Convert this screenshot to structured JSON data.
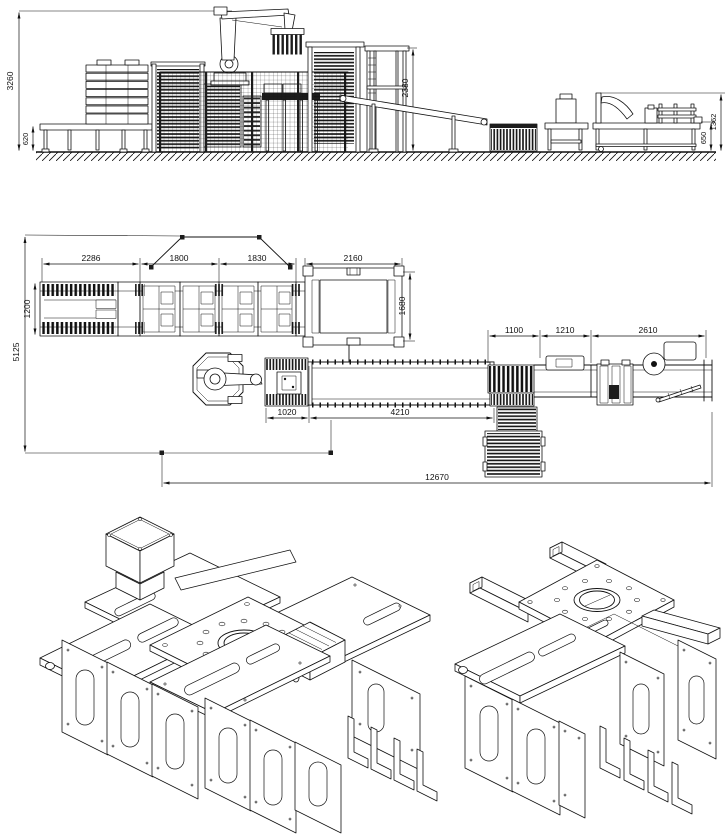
{
  "elevation_view": {
    "dimensions": {
      "overall_height": "3260",
      "infeed_conveyor_height": "620",
      "hoist_frame_height": "2380",
      "outfeed_station_height": "1362",
      "outfeed_conveyor_height": "650"
    }
  },
  "plan_view": {
    "dimensions": {
      "pallet_magazine_length": "2286",
      "pallet_station1_length": "1800",
      "pallet_station2_length": "1830",
      "lift_station_length": "2160",
      "pallet_conveyor_width": "1200",
      "lift_station_width": "1680",
      "cell_depth": "5125",
      "transfer_section_length": "1100",
      "middle_section_length": "1210",
      "outfeed_section_length": "2610",
      "gripper_section_length": "1020",
      "infeed_conveyor_length": "4210",
      "overall_line_length": "12670"
    }
  }
}
